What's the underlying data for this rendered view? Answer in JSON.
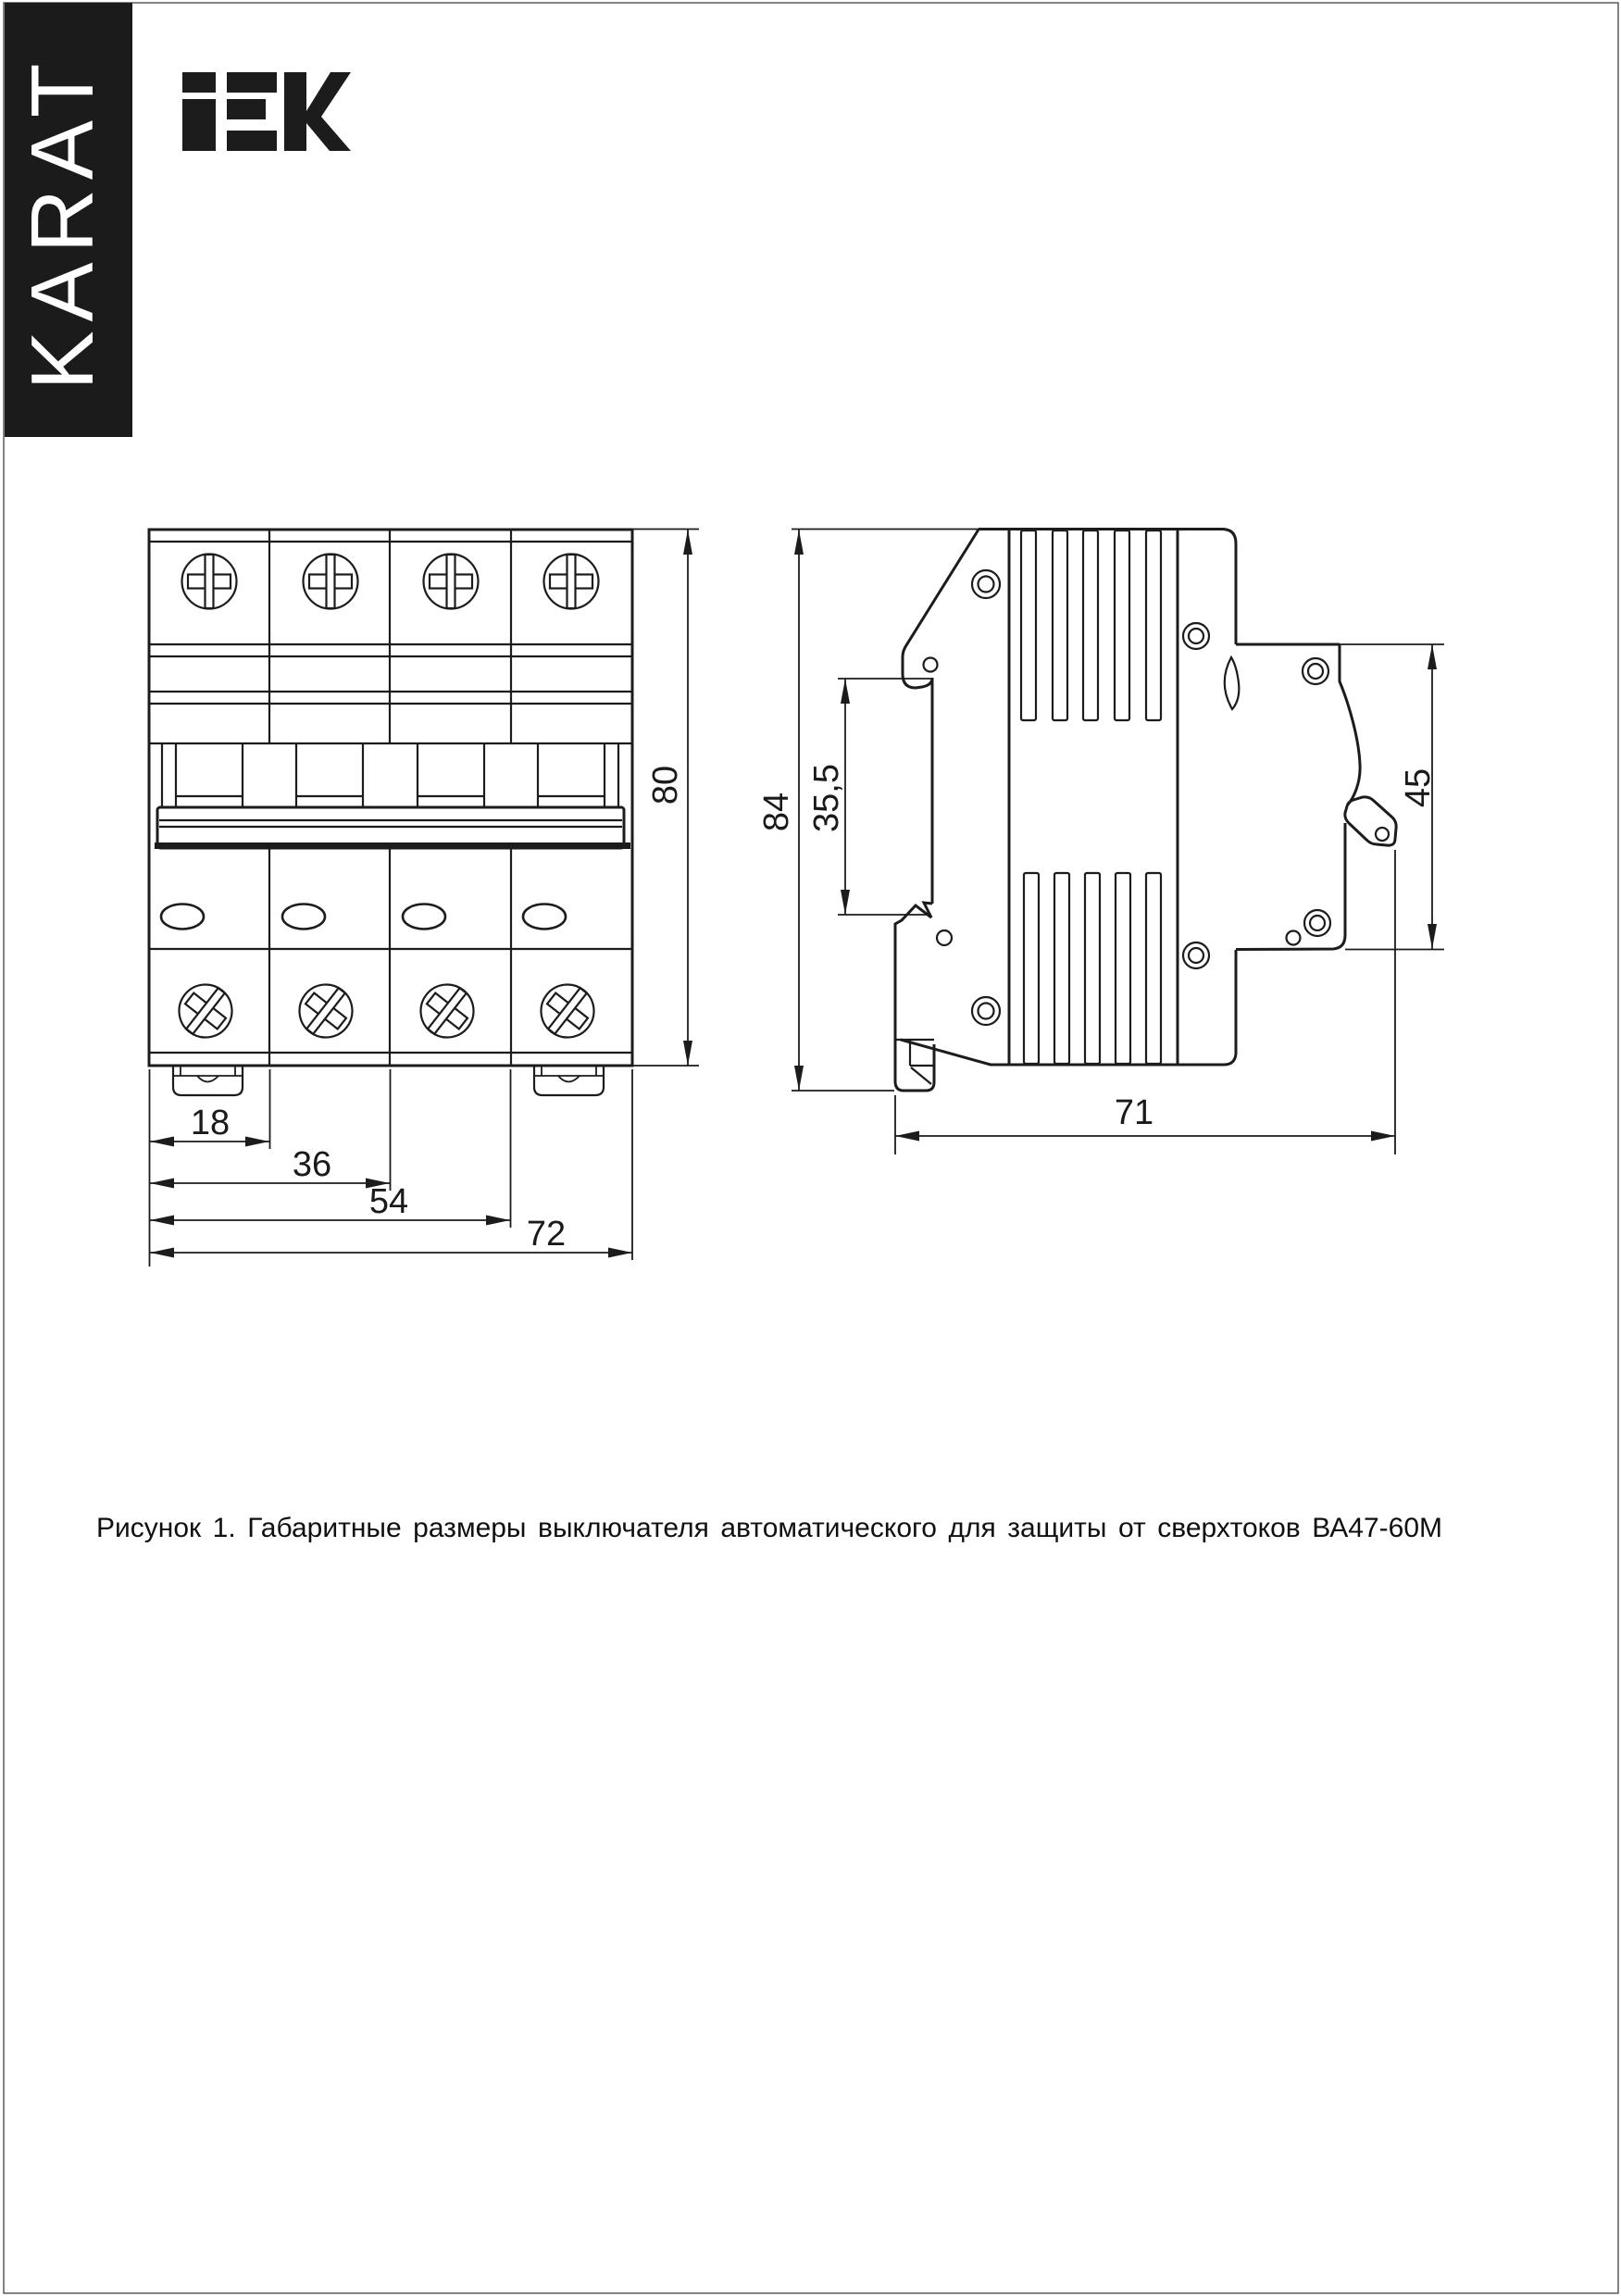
{
  "page": {
    "brand_vertical": "KARAT",
    "logo_text": "IEK",
    "caption": "Рисунок 1. Габаритные размеры выключателя автоматического для защиты от сверхтоков ВА47-60М"
  },
  "front_view": {
    "dims": {
      "height": "80",
      "module_width": "18",
      "two_modules": "36",
      "three_modules": "54",
      "total_width": "72"
    }
  },
  "side_view": {
    "dims": {
      "height": "84",
      "din_recess": "35,5",
      "front_height": "45",
      "depth": "71"
    }
  }
}
